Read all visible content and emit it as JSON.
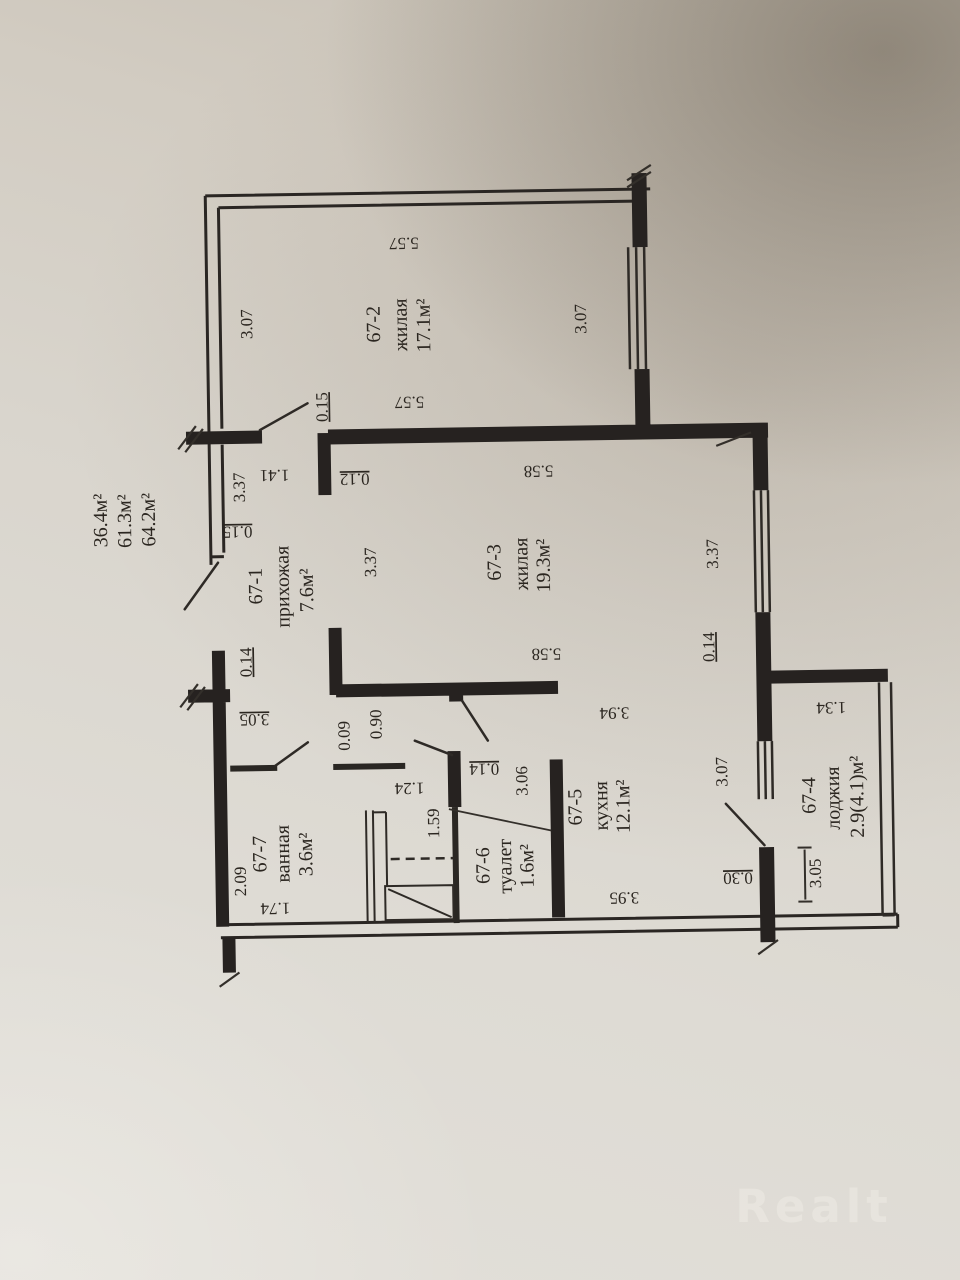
{
  "watermark": "Realt",
  "summary": [
    "36.4м²",
    "61.3м²",
    "64.2м²"
  ],
  "rooms": [
    {
      "number": "67-1",
      "name": "прихожая",
      "area": "7.6м²"
    },
    {
      "number": "67-2",
      "name": "жилая",
      "area": "17.1м²"
    },
    {
      "number": "67-3",
      "name": "жилая",
      "area": "19.3м²"
    },
    {
      "number": "67-4",
      "name": "лоджия",
      "area": "2.9(4.1)м²"
    },
    {
      "number": "67-5",
      "name": "кухня",
      "area": "12.1м²"
    },
    {
      "number": "67-6",
      "name": "туалет",
      "area": "1.6м²"
    },
    {
      "number": "67-7",
      "name": "ванная",
      "area": "3.6м²"
    }
  ],
  "dimensions": {
    "room2_top": "5.57",
    "room2_left": "3.07",
    "room2_right": "3.07",
    "room2_bottom": "5.57",
    "hall_length": "3.37",
    "hall_door": "1.41",
    "wall_015_left": "0.15",
    "wall_015_top": "0.15",
    "wall_012": "0.12",
    "room3_top": "5.58",
    "room3_left": "3.37",
    "room3_right": "3.37",
    "room3_bottom": "5.58",
    "wall_014_left": "0.14",
    "hall_305": "3.05",
    "opening_394": "3.94",
    "part_009": "0.09",
    "door_090": "0.90",
    "toilet_124": "1.24",
    "toilet_159": "1.59",
    "wall_014_toilet": "0.14",
    "kitchen_306": "3.06",
    "bath_209": "2.09",
    "bath_174": "1.74",
    "kitchen_395": "3.95",
    "kitchen_307": "3.07",
    "wall_030": "0.30",
    "loggia_305": "3.05",
    "loggia_134": "1.34",
    "wall_014_right": "0.14"
  }
}
